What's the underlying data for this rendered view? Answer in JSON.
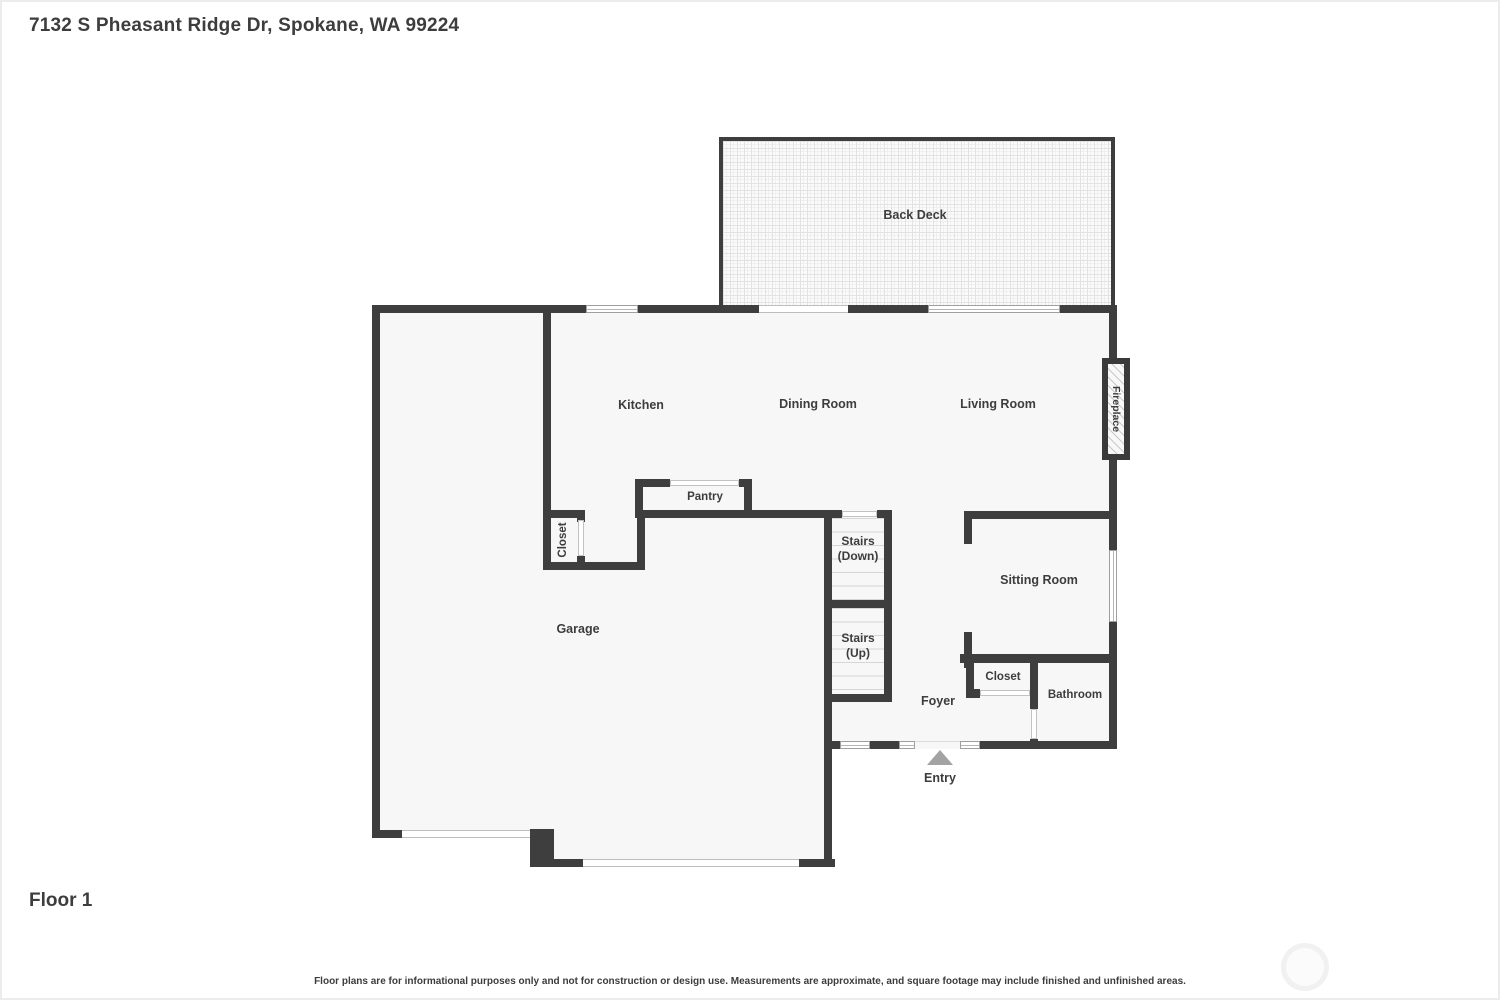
{
  "header": {
    "address": "7132 S Pheasant Ridge Dr, Spokane, WA 99224"
  },
  "footer": {
    "floor_label": "Floor 1",
    "disclaimer": "Floor plans are for informational purposes only and not for construction or design use. Measurements are approximate, and square footage may include finished and unfinished areas."
  },
  "rooms": {
    "back_deck": "Back Deck",
    "kitchen": "Kitchen",
    "dining_room": "Dining Room",
    "living_room": "Living Room",
    "fireplace": "Fireplace",
    "pantry": "Pantry",
    "closet_kitchen": "Closet",
    "garage": "Garage",
    "stairs_down_line1": "Stairs",
    "stairs_down_line2": "(Down)",
    "stairs_up_line1": "Stairs",
    "stairs_up_line2": "(Up)",
    "sitting_room": "Sitting Room",
    "foyer": "Foyer",
    "closet_foyer": "Closet",
    "bathroom": "Bathroom",
    "entry": "Entry"
  },
  "colors": {
    "background": "#ffffff",
    "wall": "#3e3e3e",
    "floor": "#f7f7f7",
    "label_text": "#3d3d3d",
    "window_frame": "#9f9f9f",
    "deck_grid": "#e2e2e2",
    "entry_arrow": "#a3a3a3",
    "watermark_ring": "#f1f1f1"
  }
}
